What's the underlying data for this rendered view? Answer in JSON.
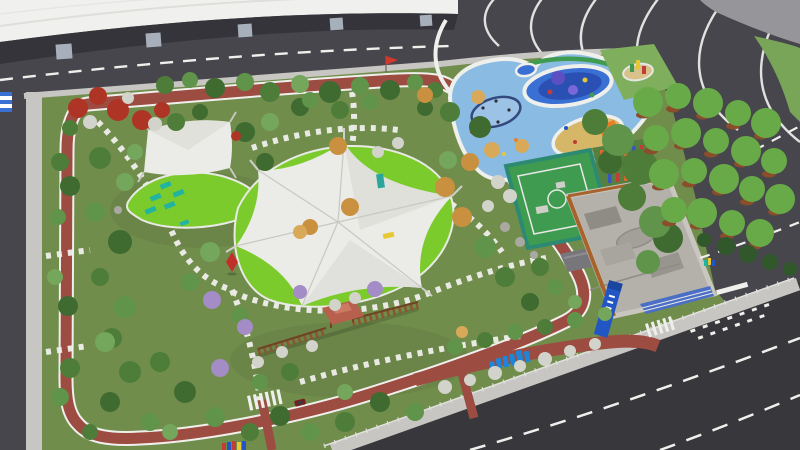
{
  "scene": {
    "title": "Aerial 3D rendering of an urban park landscape design",
    "type": "3d-architectural-rendering",
    "view": "aerial oblique",
    "setting": "Pocket park with jogging track loop, tensile shade canopies, water playground, fitness court, skate plaza and pergola, beside a white curved building and asphalt roads"
  },
  "colors": {
    "asphalt": "#46464c",
    "asphalt-dark": "#37373c",
    "sidewalk": "#c7c6c2",
    "plaza": "#96959a",
    "grass": "#718d4c",
    "lawn": "#7ccb2d",
    "track": "#9d4c42",
    "marking": "#efefec",
    "building": "#f0f0ee",
    "building-shadow": "#34343a",
    "pillar": "#a7b0ba",
    "canopy": "#ebebe7",
    "canopy-shade": "#d9d9d4",
    "play-blue": "#8abbe2",
    "pool": "#3a6fd4",
    "pool-deep": "#2a50b4",
    "equip-purple": "#5b4fc2",
    "sand": "#d6b768",
    "slide": "#e67e28",
    "court": "#3f9b50",
    "court-edge": "#2d8a72",
    "obstacle-orange": "#d96a2c",
    "obstacle-blue": "#3a55c2",
    "obstacle-red": "#c13d37",
    "skate": "#b4b1aa",
    "skate-dark": "#8f8c85",
    "skate-edge": "#a8632c",
    "sign-blue": "#2156c4",
    "letters-blue": "#1d86d8",
    "tree-dark": "#3f6b31",
    "tree": "#4e7d3a",
    "tree-mid": "#5f944a",
    "tree-light": "#74a65b",
    "tree-bright": "#68aa48",
    "autumn": "#c9913f",
    "autumn-light": "#d9a95a",
    "tree-red": "#ae3426",
    "tree-purple": "#a48cc6",
    "shrub-white": "#d2d3ca",
    "planter": "#8a4e2b",
    "hedge": "#30582b",
    "pergola": "#8a5530",
    "pergola-dark": "#6e4423",
    "pavilion-roof": "#b6604d",
    "lounger": "#22b3a1",
    "flag-red": "#d03a2e",
    "sign-teal": "#2aa79a",
    "bench-yellow": "#e8c832",
    "corner-green": "#79a558",
    "mini-lawn": "#7fae5d"
  },
  "elements": [
    {
      "name": "curved-building",
      "desc": "White curved exhibition building roof with pillars, top left"
    },
    {
      "name": "perimeter-roads",
      "desc": "Dark asphalt roads with white dashed lane markings"
    },
    {
      "name": "lane-curves",
      "desc": "Curved white lane guide lines at top-right road bend"
    },
    {
      "name": "park-lawn",
      "desc": "Olive green park grass block"
    },
    {
      "name": "jogging-track",
      "desc": "Brick-red looped jogging track with white edge lines"
    },
    {
      "name": "stepping-paths",
      "desc": "White stepping-stone footpaths winding through the park"
    },
    {
      "name": "tensile-canopy",
      "desc": "Large white star-shaped tensile membrane over bright green lawn"
    },
    {
      "name": "shade-sail",
      "desc": "Square white shade sail with teal sun loungers"
    },
    {
      "name": "water-playground",
      "desc": "Light-blue rubber playground with splash pool, purple spray equipment and circular swing"
    },
    {
      "name": "sand-play-area",
      "desc": "Tan sand pit with orange slide"
    },
    {
      "name": "fitness-court",
      "desc": "Green fenced multi-sport court with white markings"
    },
    {
      "name": "obstacle-course",
      "desc": "Grid of colorful climbing obstacle posts"
    },
    {
      "name": "skate-park",
      "desc": "Gray sunken skate plaza with ramps, timber edge and blue bleacher"
    },
    {
      "name": "park-sign",
      "desc": "Tall leaning blue monument sign"
    },
    {
      "name": "letter-sculpture",
      "desc": "Blue 3D letter sculpture on lawn"
    },
    {
      "name": "pergola",
      "desc": "Timber pergola walk with red-roofed pavilion"
    },
    {
      "name": "street-trees",
      "desc": "Rows of trees in round planters on east asphalt strip"
    },
    {
      "name": "flowering-trees",
      "desc": "Red, purple and white flowering trees and shrubs"
    }
  ]
}
